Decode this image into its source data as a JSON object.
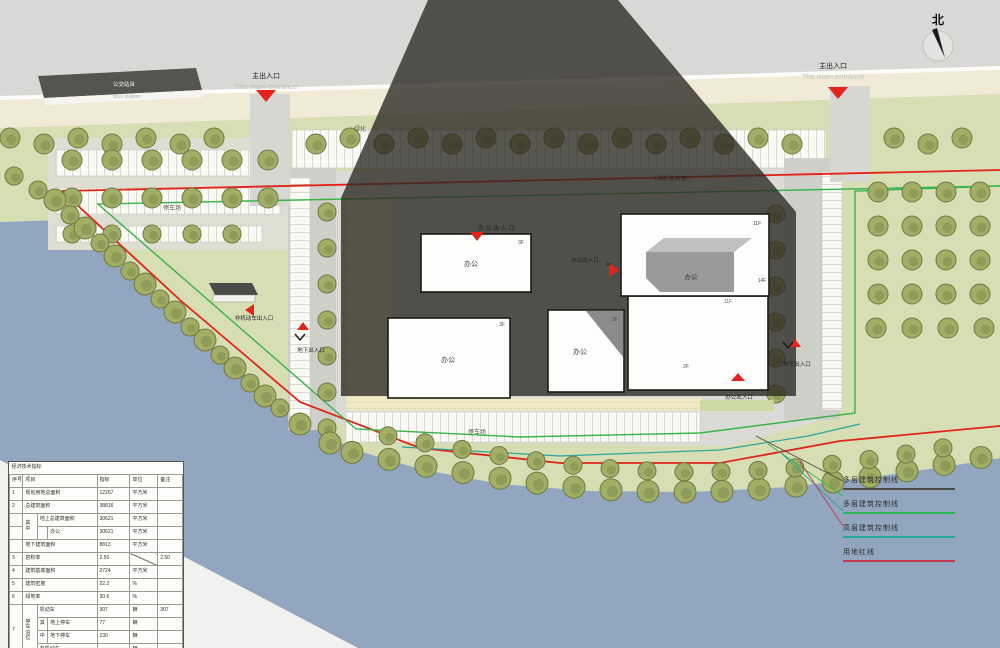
{
  "north_label": "北",
  "entrance": {
    "cn": "主出入口",
    "en": "The main entrance"
  },
  "bus_station": {
    "cn": "公交站台",
    "en": "Bus station"
  },
  "labels": {
    "office": "办公",
    "f3": "3F",
    "f2": "2F",
    "f11": "11F",
    "f14": "14F",
    "parking": "停车场",
    "green": "绿化",
    "fire_lane": "(消防登高面)",
    "office_entrance": "办公出入口",
    "underground_entrance": "地下出入口",
    "nonmotor_entrance": "非机动车出入口"
  },
  "legend": {
    "items": [
      {
        "label": "多层建筑控制线",
        "color": "#4a4a46"
      },
      {
        "label": "多层建筑控制线",
        "color": "#2fb457"
      },
      {
        "label": "高层建筑控制线",
        "color": "#2aa79b"
      },
      {
        "label": "用地红线",
        "color": "#c43a55"
      }
    ]
  },
  "colors": {
    "red_line": "#e02417",
    "green_line": "#35b44a",
    "teal_line": "#2aa79b",
    "site_green": "#d8deb4",
    "river_blue": "#92a6bf",
    "marker_red": "#e3241b"
  },
  "table": {
    "title": "经济技术指标",
    "h": {
      "no": "序号",
      "item": "项目",
      "value": "指标",
      "unit": "单位",
      "note": "备注"
    },
    "r1": {
      "no": "1",
      "item": "规划用地总面积",
      "value": "12267",
      "unit": "平方米",
      "note": ""
    },
    "r2": {
      "no": "2",
      "item": "总建筑面积",
      "value": "38816",
      "unit": "平方米",
      "note": ""
    },
    "r3": {
      "qizhong": "其中",
      "item": "地上总建筑面积",
      "value": "30621",
      "unit": "平方米",
      "note": ""
    },
    "r4": {
      "item": "办公",
      "value": "30621",
      "unit": "平方米",
      "note": ""
    },
    "r5": {
      "item": "地下建筑面积",
      "value": "8813",
      "unit": "平方米",
      "note": ""
    },
    "r6": {
      "no": "3",
      "item": "容积率",
      "value": "2.50",
      "unit": "",
      "note": "2.50"
    },
    "r7": {
      "no": "4",
      "item": "建筑基底面积",
      "value": "2724",
      "unit": "平方米",
      "note": ""
    },
    "r8": {
      "no": "5",
      "item": "建筑密度",
      "value": "22.2",
      "unit": "%",
      "note": ""
    },
    "r9": {
      "no": "6",
      "item": "绿地率",
      "value": "30.6",
      "unit": "%",
      "note": ""
    },
    "r10": {
      "no": "7",
      "group": "停车泊位",
      "item": "机动车",
      "value": "307",
      "unit": "辆",
      "note": "307"
    },
    "r11": {
      "sub": "其",
      "item": "地上停车",
      "value": "77",
      "unit": "辆",
      "note": ""
    },
    "r12": {
      "sub": "中",
      "item": "地下停车",
      "value": "230",
      "unit": "辆",
      "note": ""
    },
    "r13": {
      "item": "非机动车",
      "value": "",
      "unit": "辆",
      "note": ""
    }
  }
}
